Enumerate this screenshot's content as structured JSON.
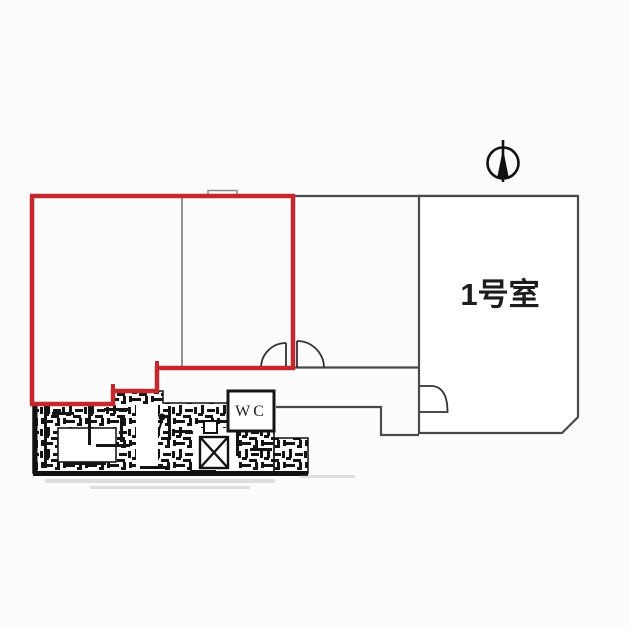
{
  "plan": {
    "title": "floor-plan",
    "labels": {
      "room1": "1号室",
      "wc": "WC"
    },
    "icons": {
      "north": "north-arrow-icon",
      "elevator": "elevator-x-icon"
    },
    "colors": {
      "highlight": "#c3292c",
      "wall": "#4a4a4a",
      "wall_light": "#7a7a7a",
      "detail": "#161616",
      "text": "#1d1d1d",
      "background": "#fcfcfc"
    }
  }
}
